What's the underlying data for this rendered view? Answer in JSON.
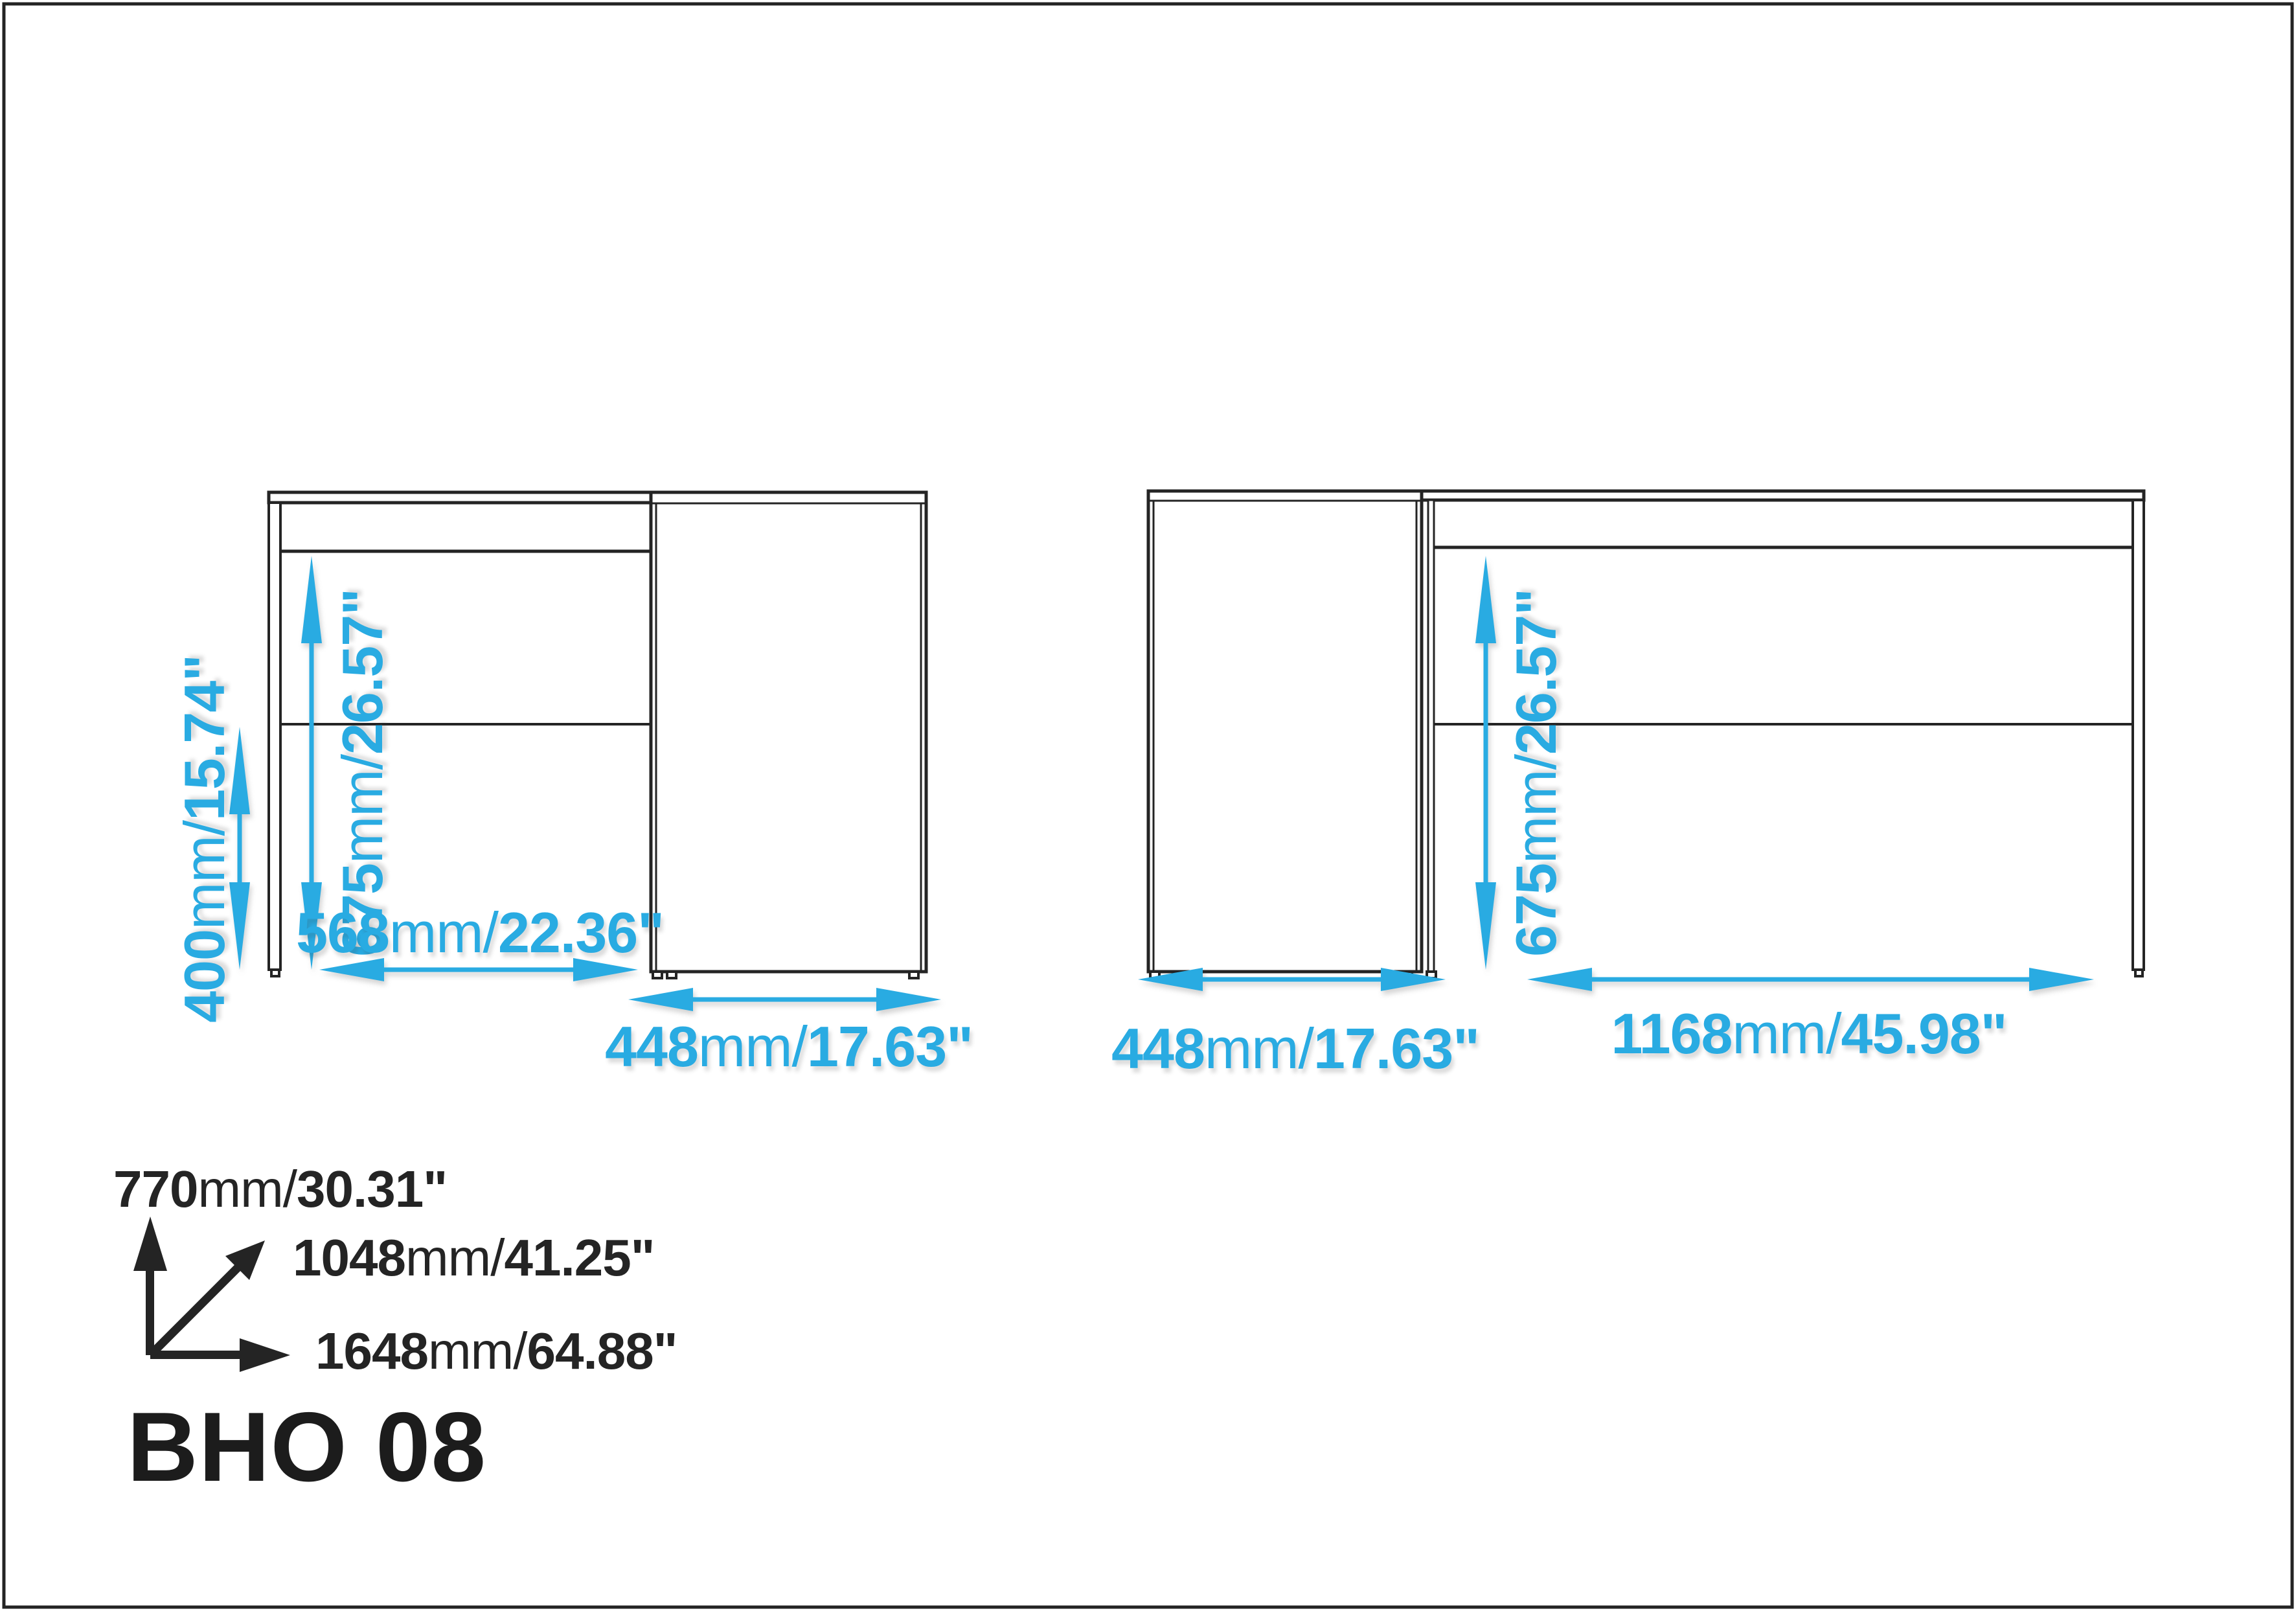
{
  "title": "BHO 08",
  "colors": {
    "accent": "#29ABE2",
    "ink": "#262424"
  },
  "dimensions": {
    "leg_height": {
      "mm": "400",
      "unit": "mm/",
      "inches": "15.74\""
    },
    "under_desk_left": {
      "mm": "675",
      "unit": "mm/",
      "inches": "26.57\""
    },
    "inner_width": {
      "mm": "568",
      "unit": "mm/",
      "inches": "22.36\""
    },
    "cabinet_left": {
      "mm": "448",
      "unit": "mm/",
      "inches": "17.63\""
    },
    "under_desk_right": {
      "mm": "675",
      "unit": "mm/",
      "inches": "26.57\""
    },
    "cabinet_right": {
      "mm": "448",
      "unit": "mm/",
      "inches": "17.63\""
    },
    "desk_span": {
      "mm": "1168",
      "unit": "mm/",
      "inches": "45.98\""
    }
  },
  "overall": {
    "height": {
      "mm": "770",
      "unit": "mm/",
      "inches": "30.31\""
    },
    "depth": {
      "mm": "1048",
      "unit": "mm/",
      "inches": "41.25\""
    },
    "width": {
      "mm": "1648",
      "unit": "mm/",
      "inches": "64.88\""
    }
  }
}
